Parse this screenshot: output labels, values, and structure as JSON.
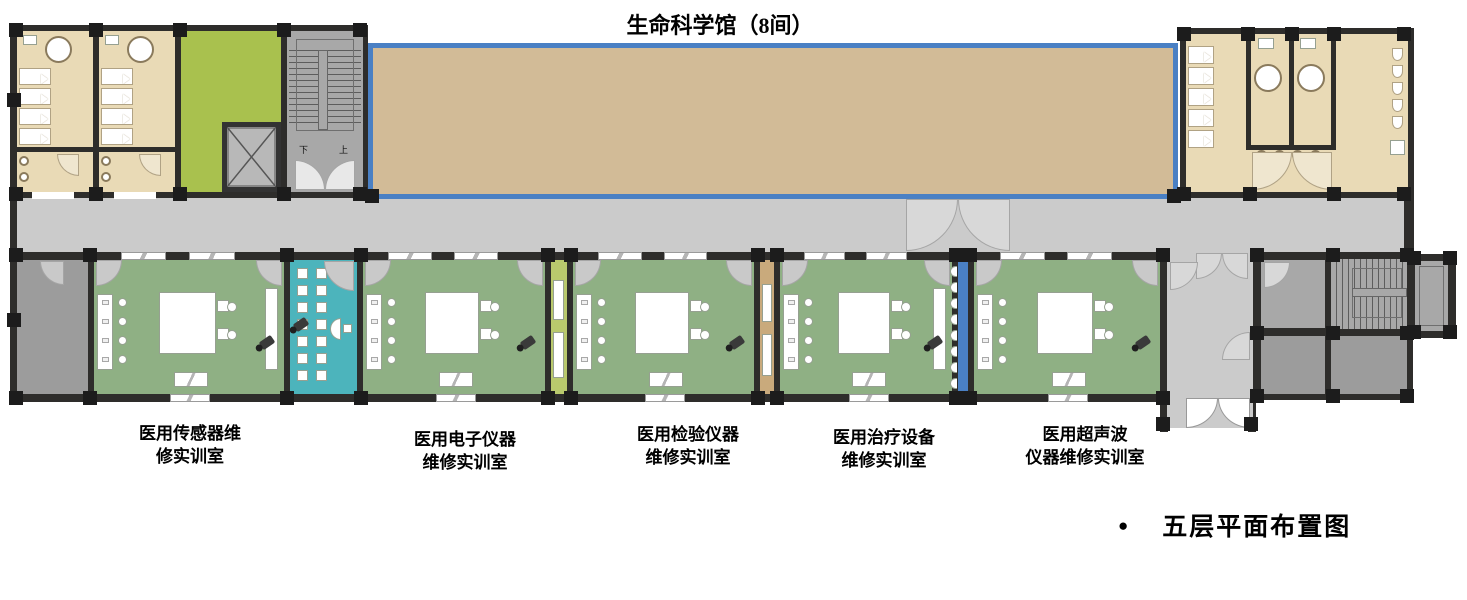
{
  "title": "生命科学馆（8间）",
  "room_labels": [
    {
      "line1": "医用传感器维",
      "line2": "修实训室"
    },
    {
      "line1": "医用电子仪器",
      "line2": "维修实训室"
    },
    {
      "line1": "医用检验仪器",
      "line2": "维修实训室"
    },
    {
      "line1": "医用治疗设备",
      "line2": "维修实训室"
    },
    {
      "line1": "医用超声波",
      "line2": "仪器维修实训室"
    }
  ],
  "caption": {
    "bullet": "●",
    "text": "五层平面布置图"
  },
  "stairwell": {
    "down": "下",
    "up": "上"
  },
  "colors": {
    "wall": "#2e2d2b",
    "column": "#1c1c1c",
    "corridor": "#cbcbcb",
    "beige": "#e9dab6",
    "tan_hall": "#d2bb97",
    "hall_border": "#4a80c4",
    "olive_room": "#a9c14e",
    "classroom_green": "#8fb084",
    "teal_room": "#4cb4bc",
    "stair_gray": "#a8a8a8",
    "room_gray": "#9c9c9c",
    "divider_olive": "#b9c96d",
    "divider_tan": "#c9aa7c",
    "divider_blue": "#4a80c4"
  }
}
